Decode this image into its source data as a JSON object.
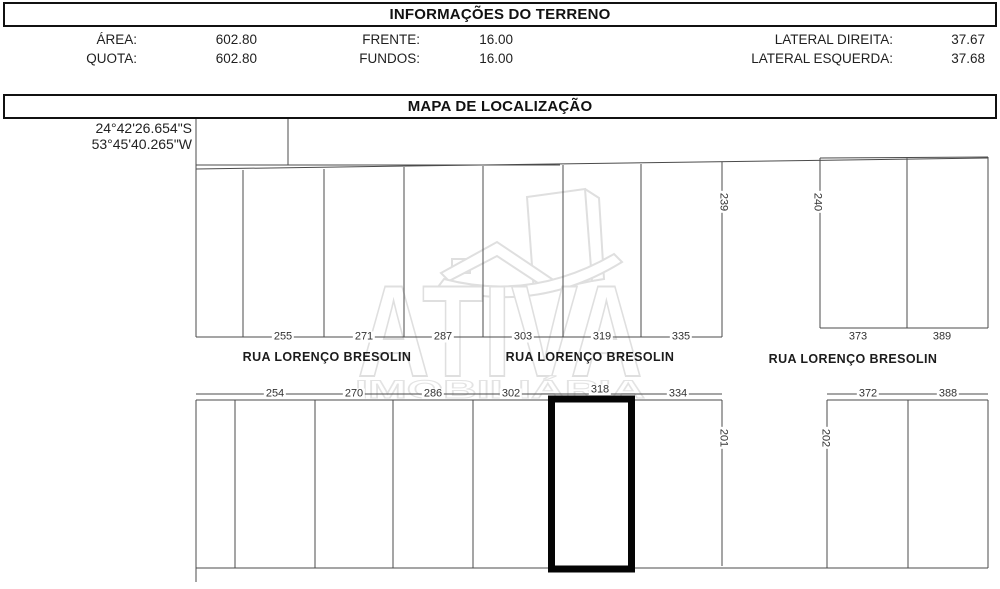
{
  "colors": {
    "line": "#4b4b4b",
    "highlight": "#000000",
    "text": "#1f1f1f",
    "watermark": "#dfdfdf"
  },
  "info": {
    "title": "INFORMAÇÕES DO TERRENO",
    "fields": [
      {
        "label": "ÁREA:",
        "value": "602.80"
      },
      {
        "label": "QUOTA:",
        "value": "602.80"
      },
      {
        "label": "FRENTE:",
        "value": "16.00"
      },
      {
        "label": "FUNDOS:",
        "value": "16.00"
      },
      {
        "label": "LATERAL DIREITA:",
        "value": "37.67"
      },
      {
        "label": "LATERAL ESQUERDA:",
        "value": "37.68"
      }
    ]
  },
  "map": {
    "title": "MAPA DE LOCALIZAÇÃO",
    "latitude": "24°42'26.654\"S",
    "longitude": "53°45'40.265\"W",
    "streets": [
      "RUA LORENÇO BRESOLIN",
      "RUA LORENÇO BRESOLIN",
      "RUA LORENÇO BRESOLIN"
    ],
    "upper_lots": [
      "255",
      "271",
      "287",
      "303",
      "319",
      "335"
    ],
    "upper_right_lots": [
      "373",
      "389"
    ],
    "lower_lots": [
      "254",
      "270",
      "286",
      "302",
      "318",
      "334"
    ],
    "lower_right_lots": [
      "372",
      "388"
    ],
    "block_labels": [
      "239",
      "240",
      "201",
      "202"
    ],
    "highlighted_lot": "318",
    "watermark_name": "ATIVA",
    "watermark_sub": "IMOBILIÁRIA"
  }
}
